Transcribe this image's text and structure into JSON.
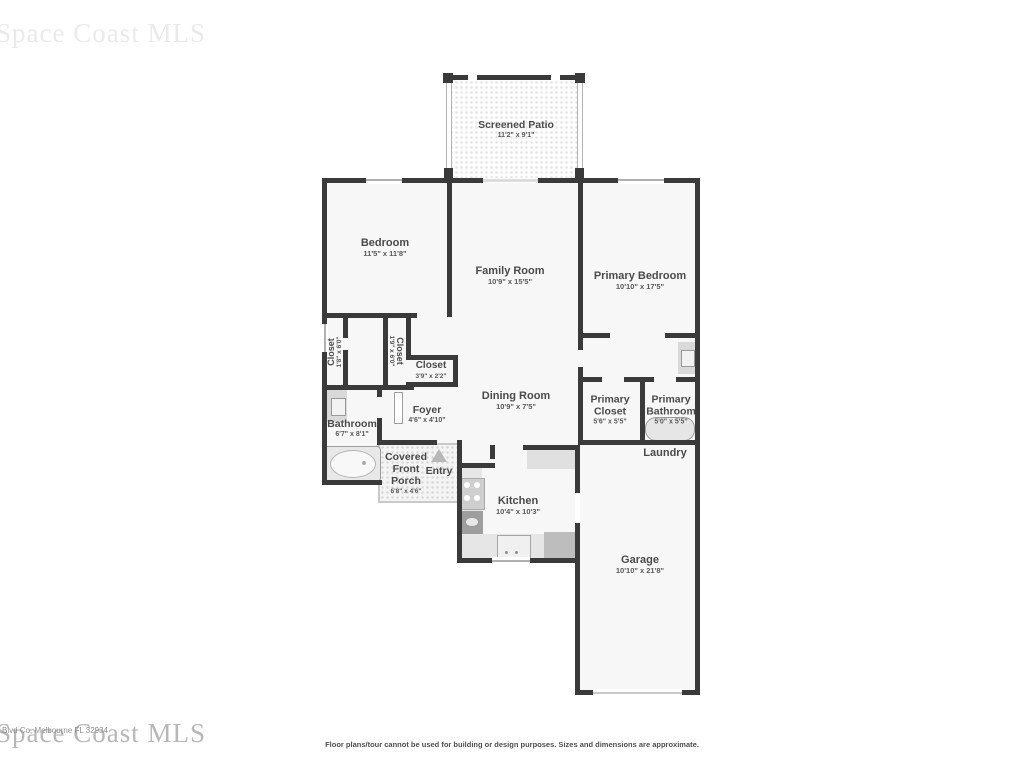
{
  "watermark": {
    "text": "Space Coast MLS",
    "overlay_small_text": "Blvd Co, Melbourne FL 32934"
  },
  "disclaimer": "Floor plans/tour cannot be used for building or design purposes. Sizes and dimensions are approximate.",
  "rooms": {
    "screened_patio": {
      "name": "Screened Patio",
      "dims": "11'2\" x 9'1\""
    },
    "bedroom": {
      "name": "Bedroom",
      "dims": "11'5\" x 11'8\""
    },
    "family_room": {
      "name": "Family Room",
      "dims": "10'9\" x 15'5\""
    },
    "primary_bedroom": {
      "name": "Primary Bedroom",
      "dims": "10'10\" x 17'5\""
    },
    "closet_left": {
      "name": "Closet",
      "dims": "1'8\" x 6'0\""
    },
    "closet_middle": {
      "name": "Closet",
      "dims": "1'9\" x 6'0\""
    },
    "closet_hall": {
      "name": "Closet",
      "dims": "3'9\" x 2'2\""
    },
    "bathroom": {
      "name": "Bathroom",
      "dims": "6'7\" x 8'1\""
    },
    "foyer": {
      "name": "Foyer",
      "dims": "4'6\" x 4'10\""
    },
    "covered_front_porch": {
      "name": "Covered Front Porch",
      "dims": "6'8\" x 4'6\""
    },
    "entry": {
      "name": "Entry"
    },
    "dining_room": {
      "name": "Dining Room",
      "dims": "10'9\" x 7'5\""
    },
    "kitchen": {
      "name": "Kitchen",
      "dims": "10'4\" x 10'3\""
    },
    "primary_closet": {
      "name": "Primary Closet",
      "dims": "5'6\" x 5'5\""
    },
    "primary_bathroom": {
      "name": "Primary Bathroom",
      "dims": "5'0\" x 5'5\""
    },
    "laundry": {
      "name": "Laundry"
    },
    "garage": {
      "name": "Garage",
      "dims": "10'10\" x 21'8\""
    }
  },
  "colors": {
    "wall": "#3a3a3a",
    "room_fill": "#f7f7f7",
    "label": "#4a4a4a",
    "watermark": "#b7b7b7"
  }
}
